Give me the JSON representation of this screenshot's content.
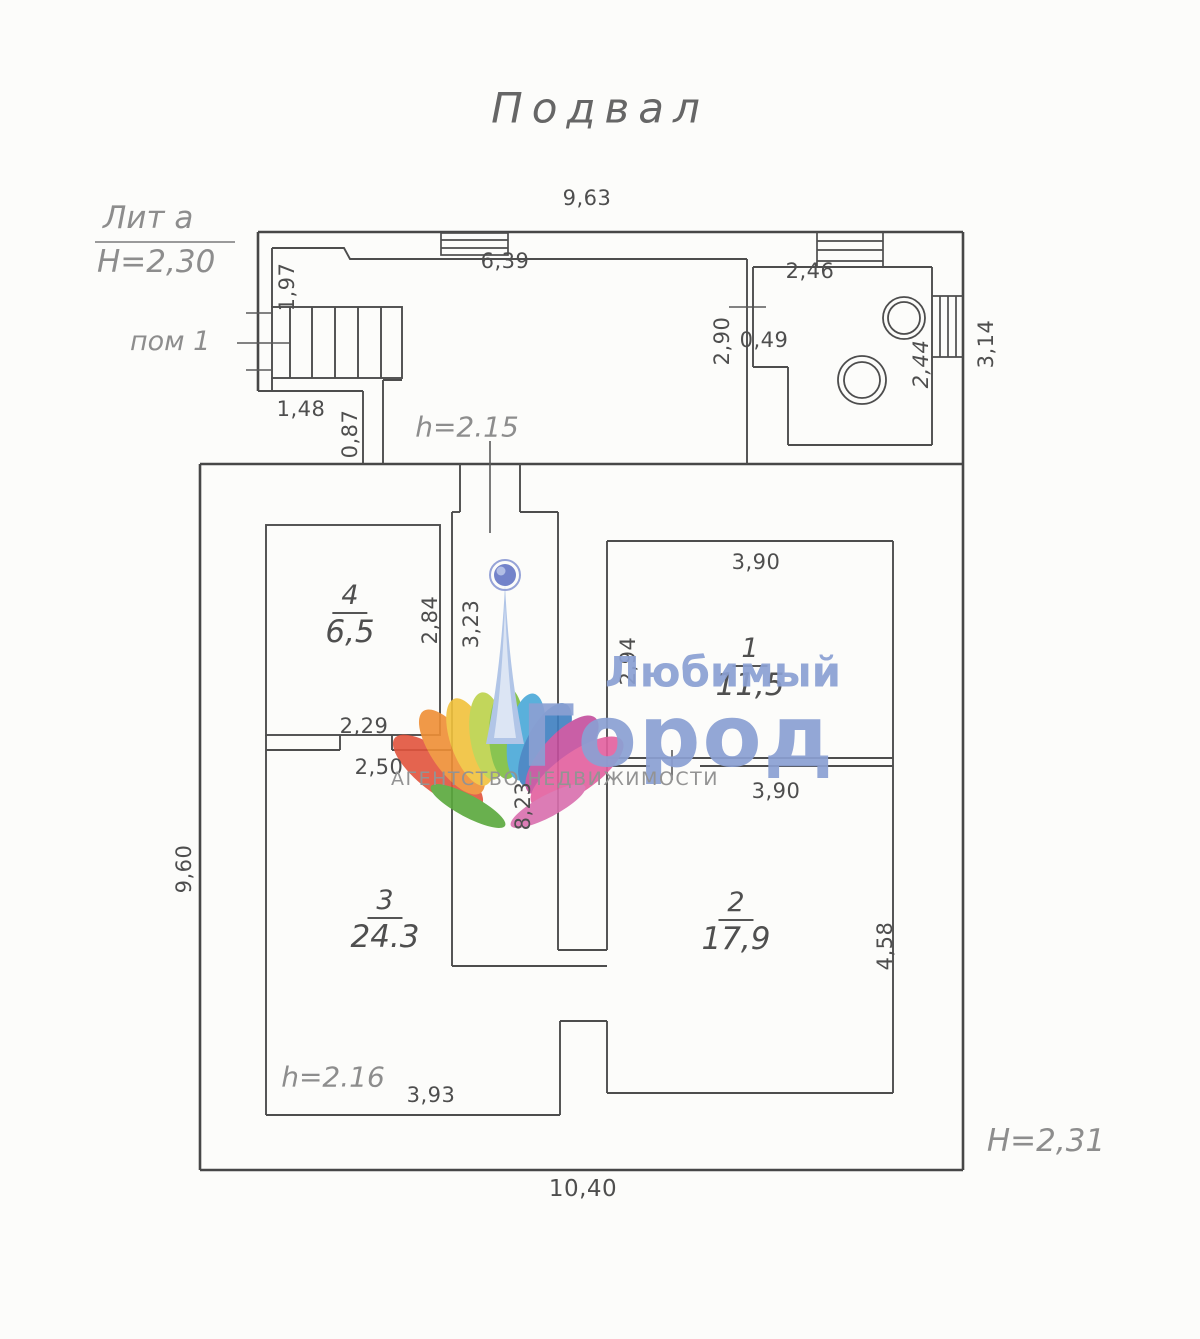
{
  "title": "Подвал",
  "annotations": {
    "lit": "Лит а",
    "annex_height": "Н=2,30",
    "room_ref": "пом 1",
    "corridor_height": "h=2.15",
    "room3_height": "h=2.16",
    "main_height": "Н=2,31"
  },
  "rooms": [
    {
      "number": "4",
      "area": "6,5"
    },
    {
      "number": "1",
      "area": "11,5"
    },
    {
      "number": "3",
      "area": "24.3"
    },
    {
      "number": "2",
      "area": "17,9"
    }
  ],
  "dimensions": {
    "top_total": "9,63",
    "annex_inner_width": "6,39",
    "stairs_side": "1,97",
    "annex_right_inner": "2,90",
    "boiler_top": "2,46",
    "boiler_step": "0,49",
    "boiler_right": "2,44",
    "right_window": "3,14",
    "nook_width": "1,48",
    "nook_height": "0,87",
    "room4_side": "2,84",
    "corridor_upper": "3,23",
    "room1_top": "3,90",
    "room1_side": "2,94",
    "room1_bottom": "3,90",
    "corridor_total": "8,23",
    "room4_door": "2,29",
    "room3_door": "2,50",
    "left_total": "9,60",
    "room2_side": "4,58",
    "room3_bottom": "3,93",
    "bottom_total": "10,40"
  },
  "watermark": {
    "brand_line1": "Любимый",
    "brand_line2": "Город",
    "subtitle": "АГЕНТСТВО НЕДВИЖИМОСТИ",
    "text_color": "#8ba0d3"
  }
}
